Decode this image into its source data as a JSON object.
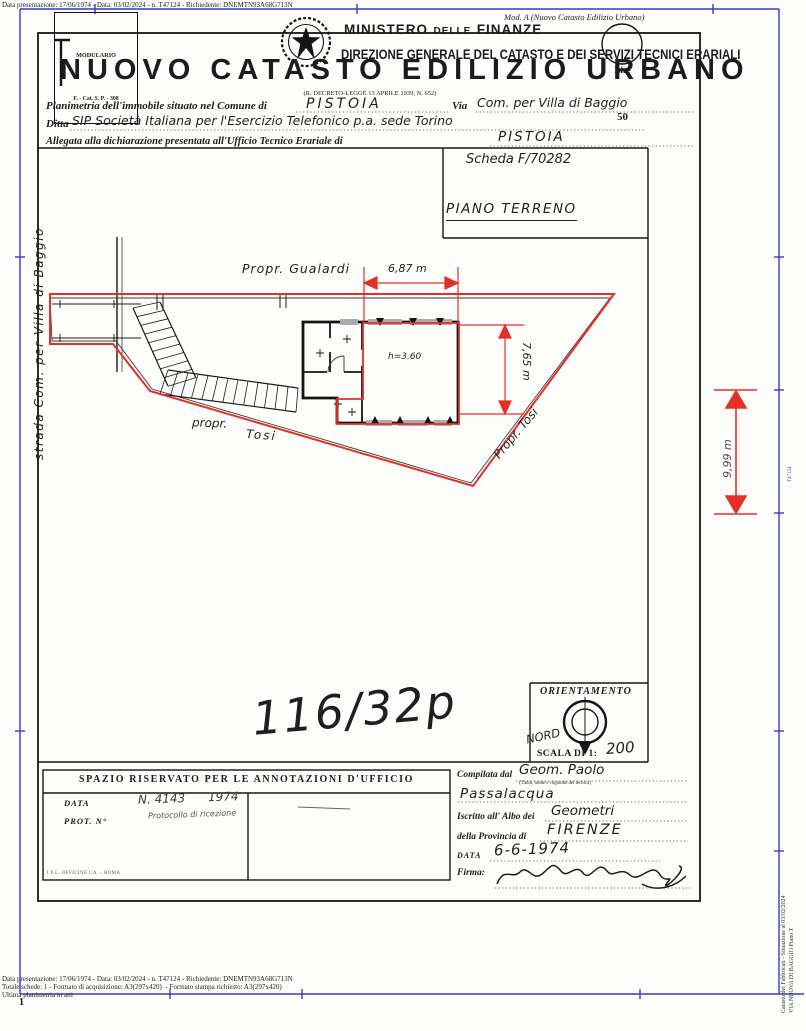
{
  "scan": {
    "top_meta": "Data presentazione: 17/06/1974 - Data: 03/02/2024 - n. T47124 - Richiedente: DNEMTN93A68G713N",
    "bottom_meta_1": "Data presentazione: 17/06/1974 - Data: 03/02/2024 - n. T47124 - Richiedente: DNEMTN93A68G713N",
    "bottom_meta_2": "Totale schede: 1 - Formato di acquisizione: A3(297x420)  - Formato stampa richiesto: A3(297x420)",
    "bottom_meta_3": "Ultima planimetria in atti",
    "side_meta_1": "Catasto dei Fabbricati - Situazione al 03/02/2024",
    "side_meta_2": "VIA NUOVA DI BAGGIO Piano T",
    "page_number": "1",
    "ruler_label": "T47124",
    "colors": {
      "frame_blue": "#3a3ac8",
      "annotation_red": "#e23028",
      "ink": "#1c1c1c"
    }
  },
  "header": {
    "modulario_line1": "MODULARIO",
    "modulario_line2": "F. - Cat. S. P. - 308",
    "mod_a": "Mod. A (Nuovo Catasto Edilizio Urbano)",
    "ministry": "MINISTERO",
    "ministry_delle": "DELLE",
    "ministry_finanze": "FINANZE",
    "direzione": "DIREZIONE GENERALE DEL CATASTO E DEI SERVIZI TECNICI ERARIALI",
    "lire_line1": "Lire",
    "lire_line2": "50",
    "title": "NUOVO CATASTO EDILIZIO URBANO",
    "subtitle": "(R. DECRETO-LEGGE 13 APRILE 1939, N. 652)"
  },
  "form": {
    "line1_label": "Planimetria dell'immobile situato nel Comune di",
    "line1_value": "PISTOIA",
    "line1_via_label": "Via",
    "line1_via_value": "Com. per Villa di Baggio",
    "line2_label": "Ditta",
    "line2_value": "SIP Società Italiana per l'Esercizio Telefonico p.a. sede Torino",
    "line3_label": "Allegata alla dichiarazione presentata all'Ufficio Tecnico Erariale di",
    "line3_value": "PISTOIA"
  },
  "plan": {
    "scheda": "Scheda F/70282",
    "piano": "PIANO TERRENO",
    "street_label": "strada Com. per Villa di Baggio",
    "propr_gualardi": "Propr. Gualardi",
    "propr_tosi_left_1": "propr.",
    "propr_tosi_left_2": "Tosi",
    "propr_tosi_right": "Propr. Tosi",
    "dim_width": "6,87 m",
    "dim_height": "7,65 m",
    "dim_right": "9,99 m",
    "room_height": "h=3.60",
    "sheet_ref": "116/32p"
  },
  "orientation": {
    "title": "ORIENTAMENTO",
    "nord": "NORD",
    "scala": "SCALA DI 1:",
    "scala_value": "200"
  },
  "annotations_box": {
    "title": "SPAZIO RISERVATO PER LE ANNOTAZIONI D'UFFICIO",
    "data_label": "DATA",
    "prot_label": "PROT. N°",
    "stamp_line1": "N. 4143      1974",
    "stamp_line2": "Protocollo di ricezione",
    "printer_mark": "I.P.L. OFFICINE CA. - ROMA"
  },
  "compiler_box": {
    "compilata_label": "Compilata dal",
    "compilata_value": "Geom. Paolo",
    "compilata_value2": "Passalacqua",
    "compilata_note": "(Titolo, nome e cognome del tecnico)",
    "iscritto_label": "Iscritto all' Albo dei",
    "iscritto_value": "Geometri",
    "provincia_label": "della Provincia di",
    "provincia_value": "FIRENZE",
    "data_label": "DATA",
    "data_value": "6-6-1974",
    "firma_label": "Firma:"
  }
}
